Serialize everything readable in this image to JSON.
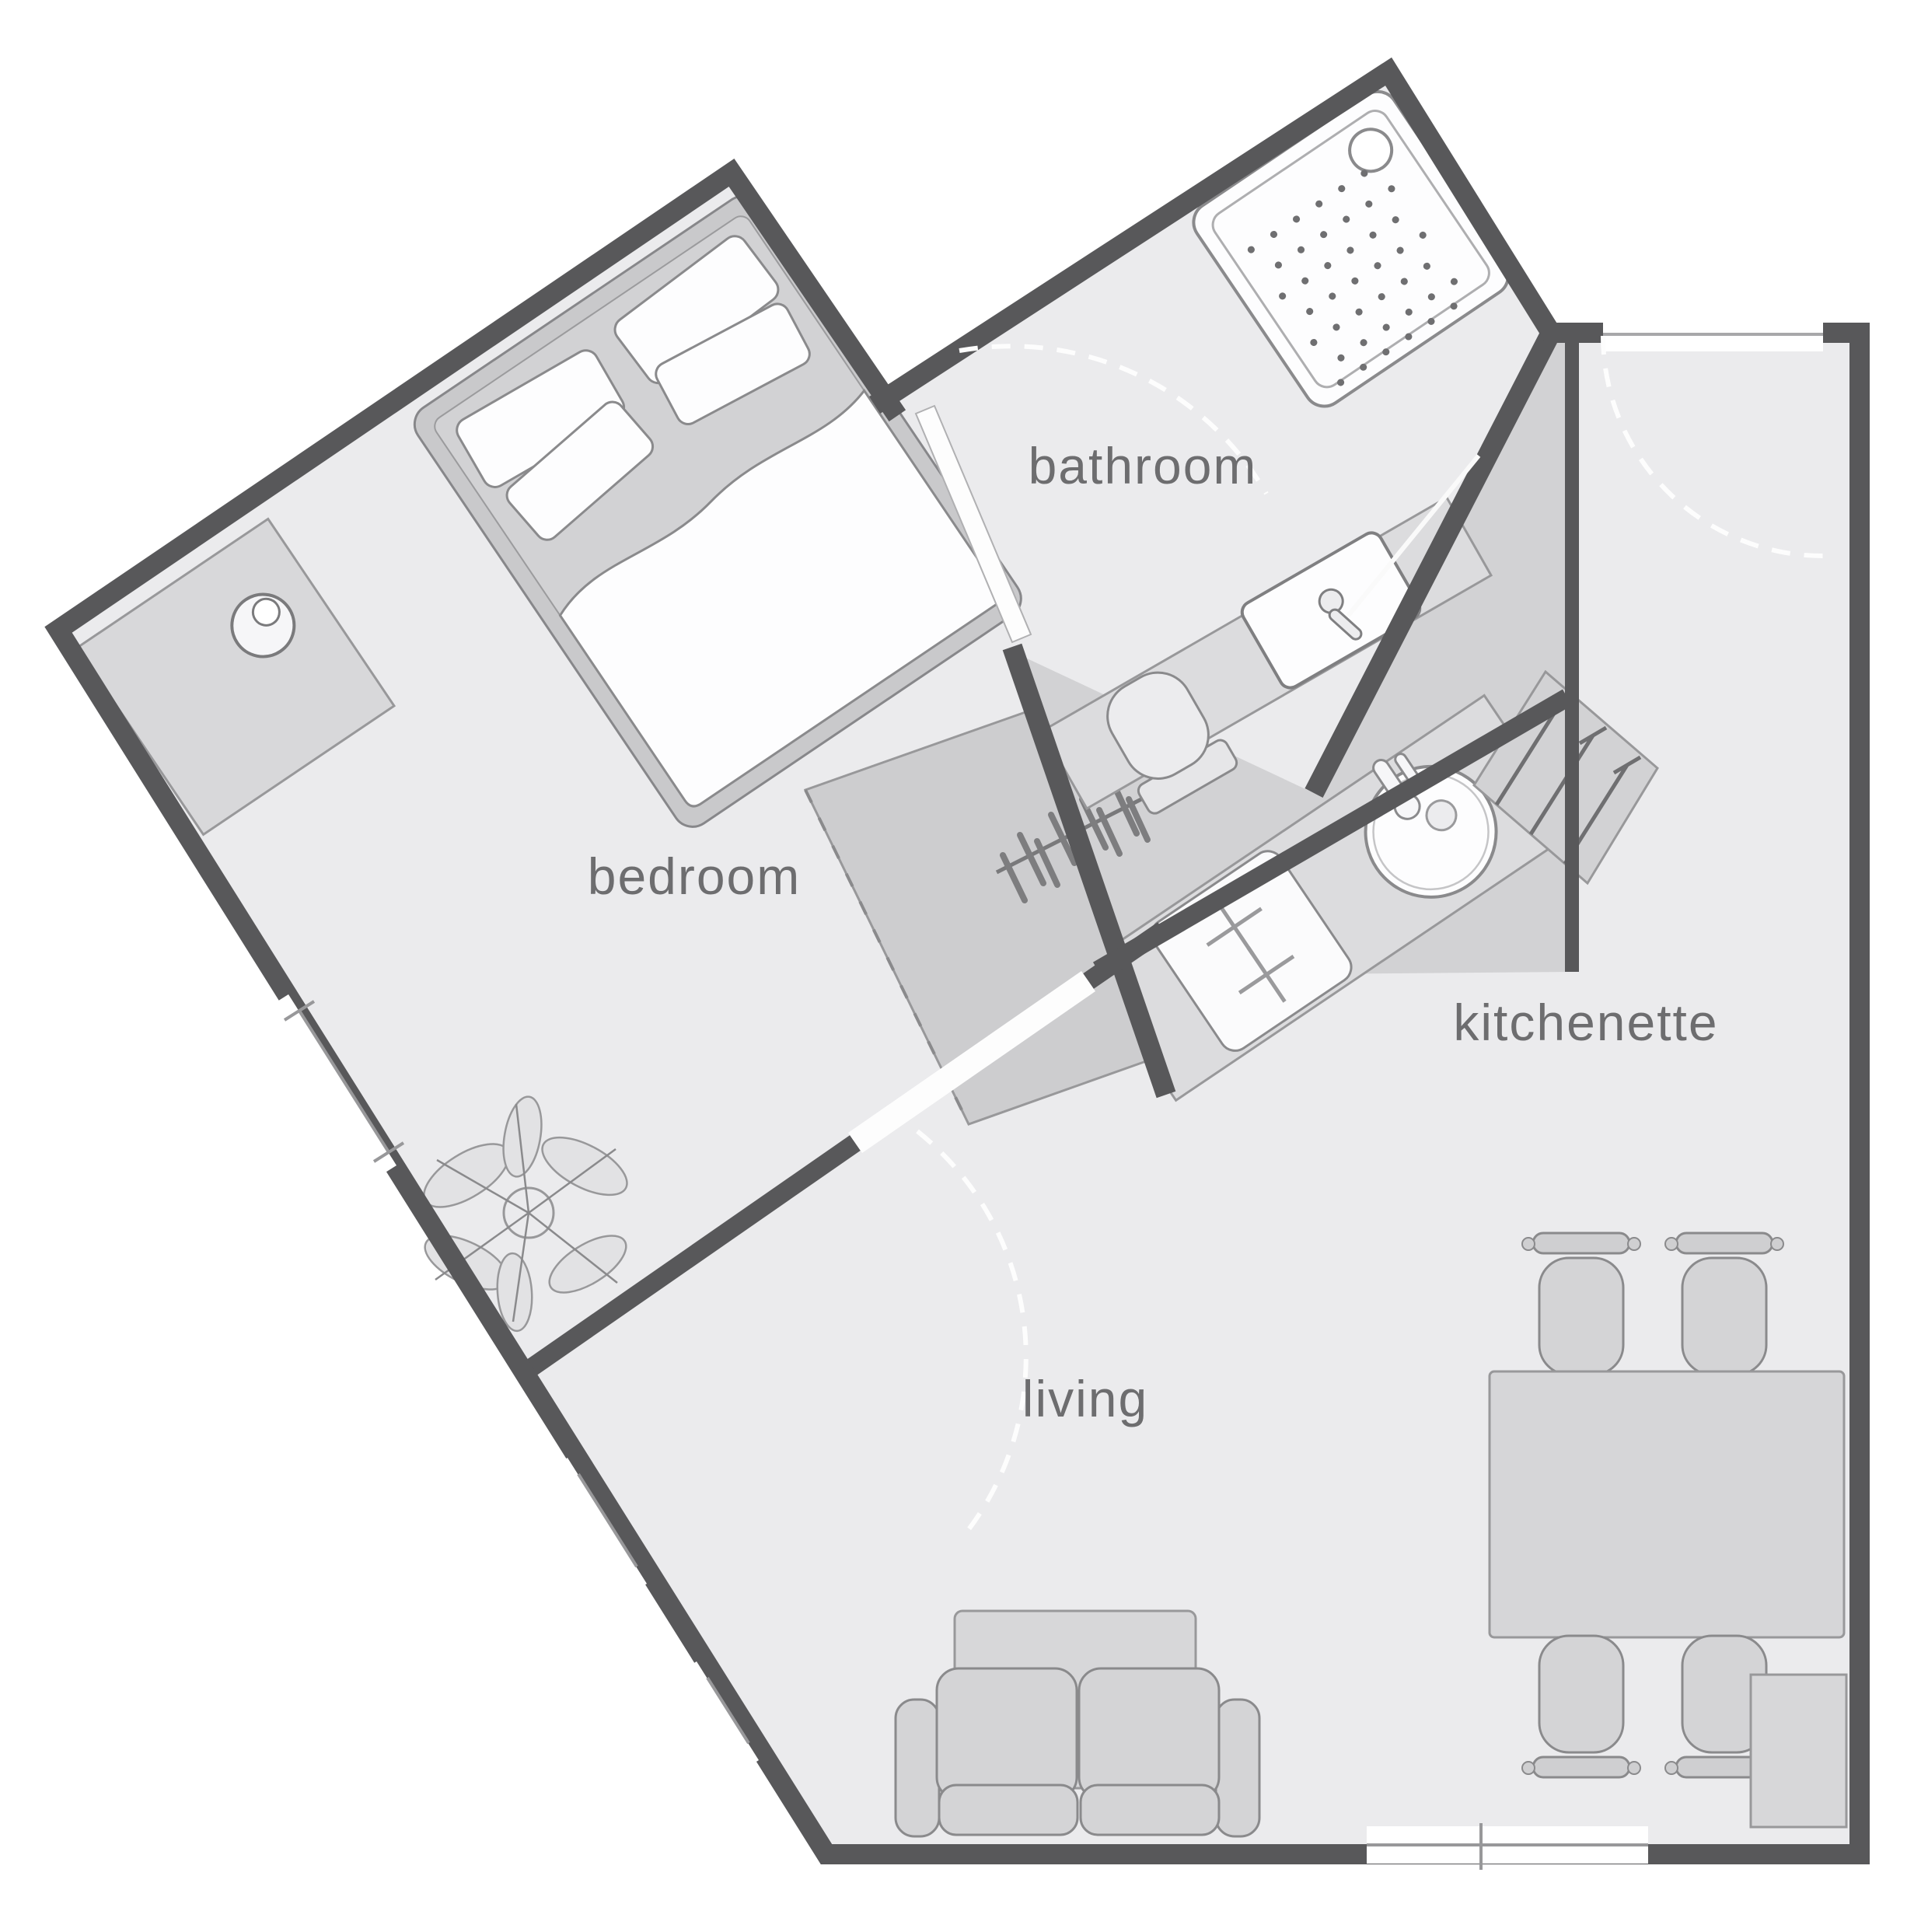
{
  "plan": {
    "title": "studio apartment floor plan",
    "rooms": [
      {
        "id": "bedroom",
        "label": "bedroom"
      },
      {
        "id": "bathroom",
        "label": "bathroom"
      },
      {
        "id": "kitchenette",
        "label": "kitchenette"
      },
      {
        "id": "living",
        "label": "living"
      }
    ],
    "furniture_icons": [
      "double-bed-icon",
      "pillow-icon",
      "duvet-icon",
      "dresser-icon",
      "bedside-lamp-icon",
      "wardrobe-rail-icon",
      "clothes-hanger-icon",
      "shower-tray-icon",
      "shower-drain-icon",
      "toilet-icon",
      "washbasin-icon",
      "bathroom-counter-icon",
      "kitchen-counter-icon",
      "kitchen-sink-icon",
      "faucet-icon",
      "stove-icon",
      "shelf-unit-icon",
      "dining-table-icon",
      "chair-icon",
      "sofa-icon",
      "coffee-table-icon",
      "tv-cabinet-icon",
      "plant-icon",
      "door-swing-icon",
      "window-icon"
    ],
    "colors": {
      "background": "#ffffff",
      "floor": "#ebebed",
      "hall_floor": "#d2d2d4",
      "wall": "#58585a",
      "thin_line": "#98989a",
      "furniture_fill": "#d4d4d6",
      "fixture_white": "#fdfdfe",
      "label_text": "#6d6d6f"
    }
  }
}
